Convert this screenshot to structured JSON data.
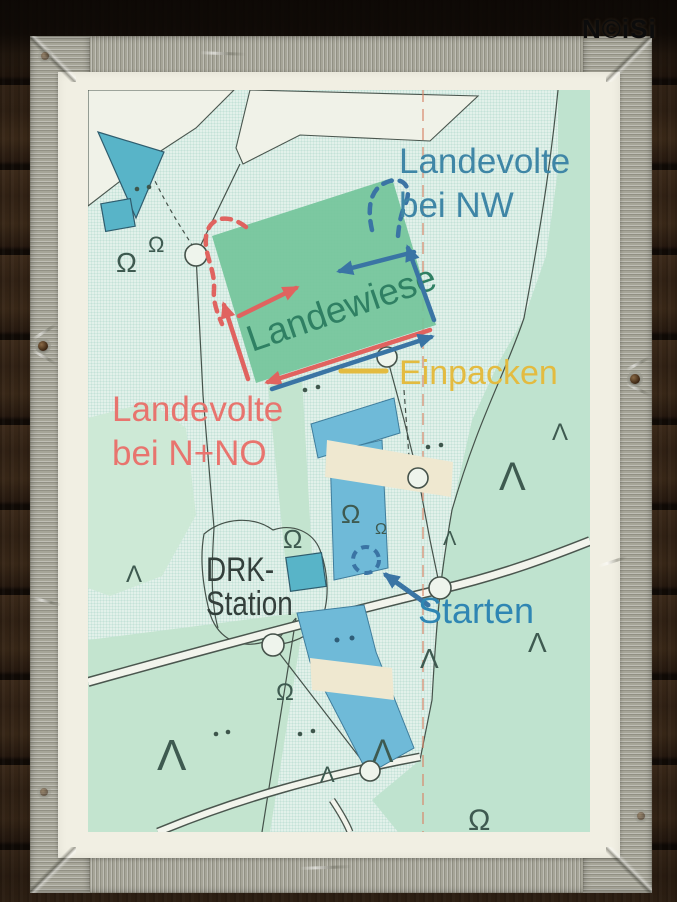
{
  "watermark": "N©iSi",
  "map": {
    "labels": {
      "landevolte_nw_line1": "Landevolte",
      "landevolte_nw_line2": "bei NW",
      "landewiese": "Landewiese",
      "einpacken": "Einpacken",
      "landevolte_nno_line1": "Landevolte",
      "landevolte_nno_line2": "bei N+NO",
      "drk_line1": "DRK-",
      "drk_line2": "Station",
      "starten": "Starten"
    },
    "symbols": {
      "omega": "Ω",
      "lambda": "Λ"
    },
    "colors": {
      "annotation_blue": "#3a74a4",
      "annotation_red": "#e0635f",
      "annotation_yellow": "#e3bb40",
      "landing_field_green": "#74c59b",
      "landewiese_text_green": "#2f8063",
      "starten_blue": "#2f86b3",
      "landevolte_nw_blue": "#3f86a6",
      "map_field_blue": "#6fbad8",
      "map_green": "#bfe3cf",
      "map_background": "#e2f1ea",
      "paper": "#f1efe3",
      "tape": "#a6a598"
    }
  }
}
